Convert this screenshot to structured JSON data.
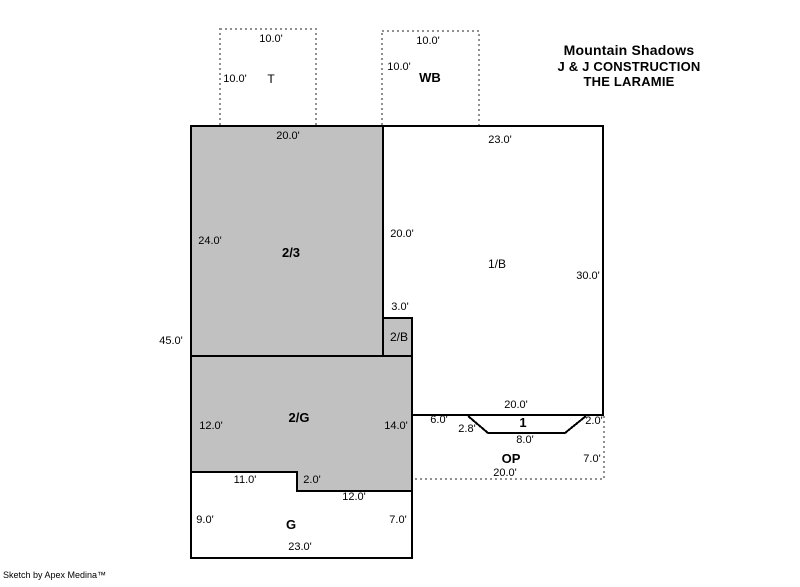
{
  "header": {
    "line1": "Mountain Shadows",
    "line2": "J & J CONSTRUCTION",
    "line3": "THE LARAMIE"
  },
  "credit": "Sketch by Apex Medina™",
  "colors": {
    "area_fill_gray": "#c1c1c1",
    "outline": "#000000",
    "dashed_line": "#909090",
    "background": "#ffffff"
  },
  "areas": {
    "t": {
      "label": "T",
      "top_dim": "10.0'",
      "left_dim": "10.0'"
    },
    "wb": {
      "label": "WB",
      "top_dim": "10.0'",
      "left_dim": "10.0'"
    },
    "a23": {
      "label": "2/3",
      "top_dim": "20.0'",
      "left_dim": "24.0'"
    },
    "b1": {
      "label": "1/B",
      "top_dim": "23.0'",
      "left_dim": "20.0'",
      "right_dim": "30.0'"
    },
    "b2": {
      "label": "2/B",
      "top_dim": "3.0'"
    },
    "g2": {
      "label": "2/G",
      "left_dim": "12.0'",
      "right_dim": "14.0'"
    },
    "g": {
      "label": "G",
      "notch_left_dim": "11.0'",
      "notch_step_dim": "2.0'",
      "notch_right_dim": "12.0'",
      "left_dim": "9.0'",
      "right_dim": "7.0'",
      "bottom_dim": "23.0'"
    },
    "op": {
      "label": "OP",
      "top_dim": "20.0'",
      "right_dim": "7.0'",
      "bottom_dim": "20.0'"
    },
    "one": {
      "label": "1",
      "left_run_dim": "6.0'",
      "left_diag_dim": "2.8'",
      "bottom_dim": "8.0'",
      "right_diag_dim": "2.0'"
    }
  },
  "left_total_dim": "45.0'"
}
